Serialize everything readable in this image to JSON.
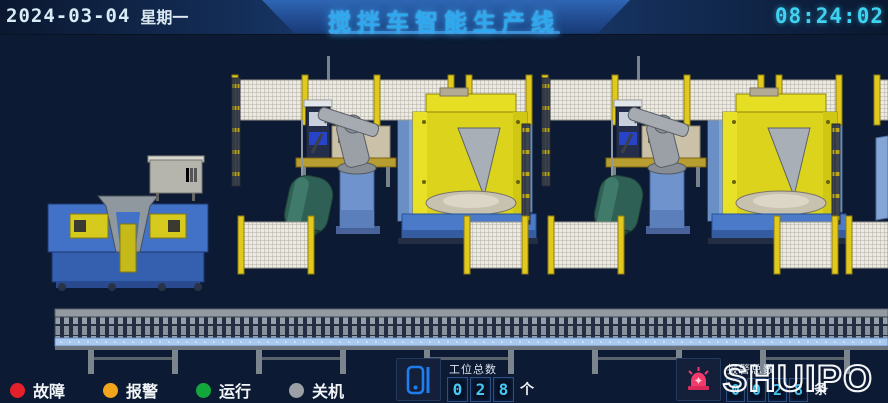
{
  "header": {
    "date": "2024-03-04",
    "weekday": "星期一",
    "title": "搅拌车智能生产线",
    "time": "08:24:02",
    "title_color": "#2ea9f0",
    "clock_color": "#3fd2f2"
  },
  "legend": {
    "items": [
      {
        "label": "故障",
        "color": "#e6202a",
        "icon": "fault-status-dot"
      },
      {
        "label": "报警",
        "color": "#f2a51c",
        "icon": "alarm-status-dot"
      },
      {
        "label": "运行",
        "color": "#12a73a",
        "icon": "running-status-dot"
      },
      {
        "label": "关机",
        "color": "#9aa0a6",
        "icon": "off-status-dot"
      }
    ]
  },
  "counters": {
    "stations": {
      "icon": "device-icon",
      "label": "工位总数",
      "digits": [
        "0",
        "2",
        "8"
      ],
      "unit": "个",
      "digit_color": "#46c8f5"
    },
    "alarms": {
      "icon": "siren-icon",
      "label": "报警总数",
      "digits": [
        "0",
        "0",
        "2",
        "8"
      ],
      "unit": "条",
      "digit_color": "#46c8f5"
    }
  },
  "logo": {
    "text": "SHUIPO"
  }
}
